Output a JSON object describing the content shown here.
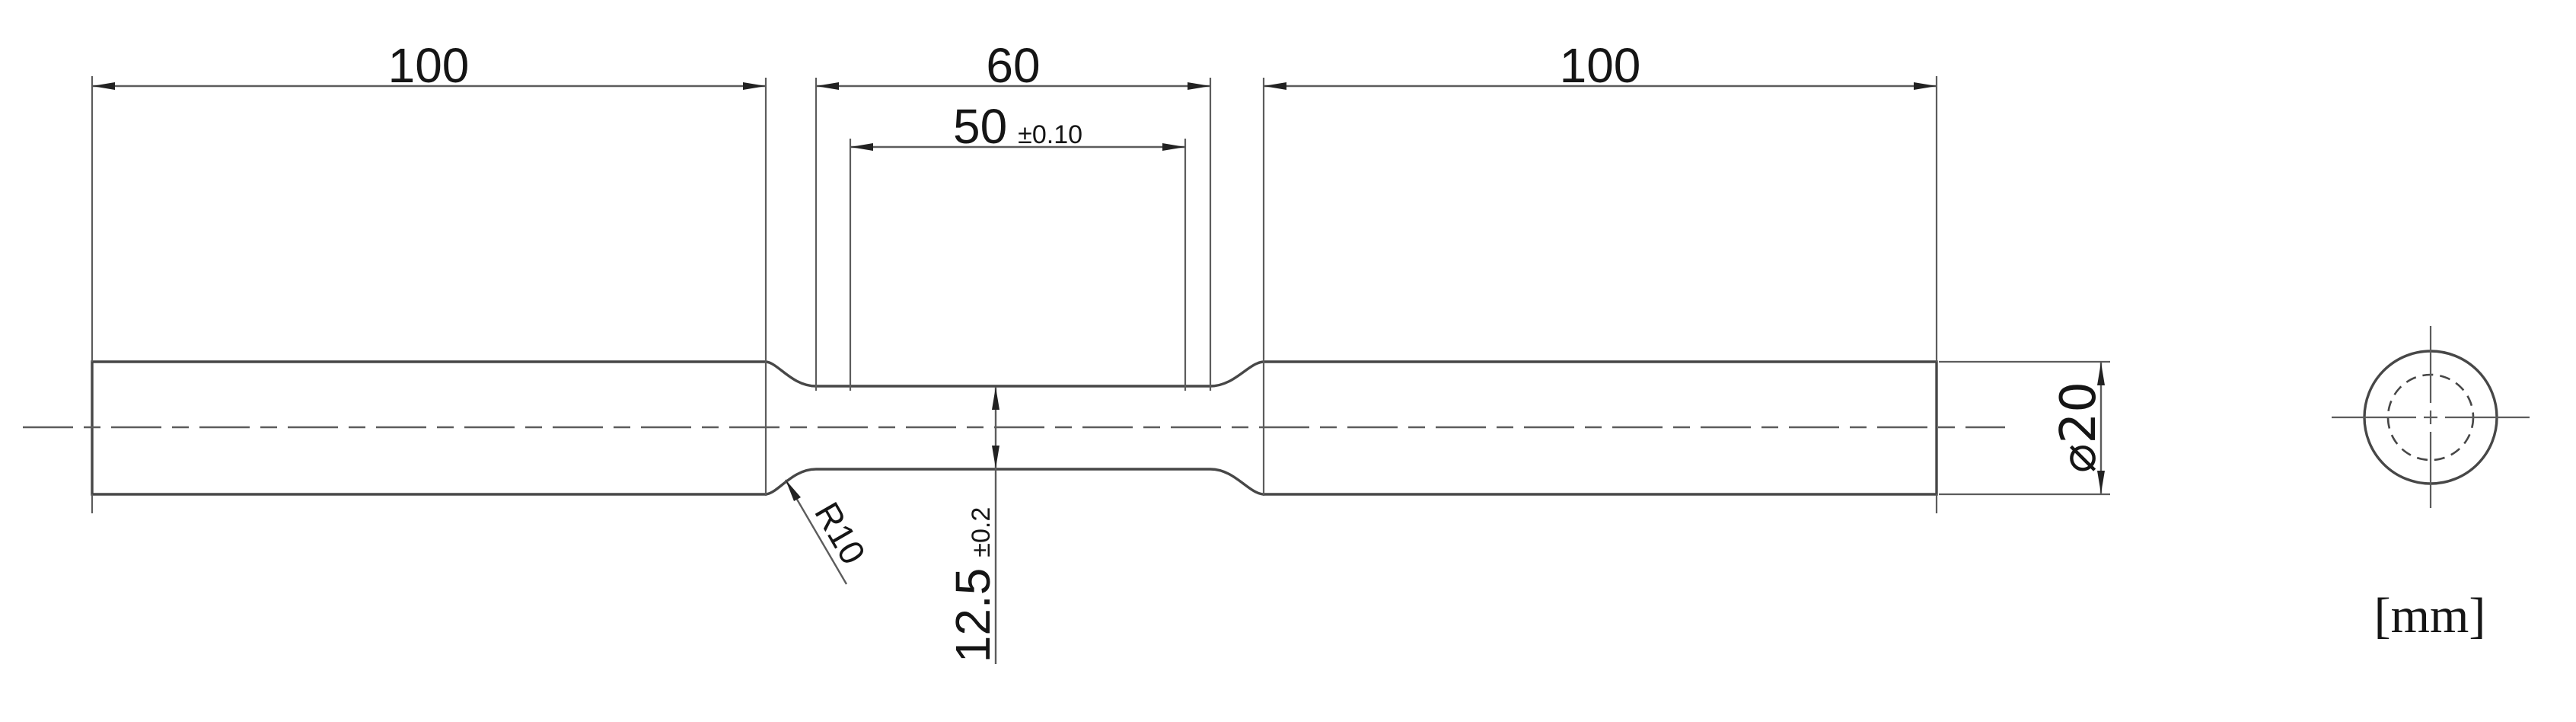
{
  "colors": {
    "outline": "#474747",
    "thin_line": "#5c5c5c",
    "text": "#151515",
    "background": "#ffffff"
  },
  "units_label": "[mm]",
  "dims": {
    "left_grip_length": {
      "value": "100"
    },
    "reduced_section_length": {
      "value": "60"
    },
    "right_grip_length": {
      "value": "100"
    },
    "gauge_length": {
      "value": "50",
      "tolerance": "±0.10"
    },
    "gauge_diameter": {
      "value": "12.5",
      "tolerance": "±0.2"
    },
    "grip_diameter": {
      "value": "⌀20"
    },
    "fillet_radius": {
      "value": "R10"
    }
  }
}
